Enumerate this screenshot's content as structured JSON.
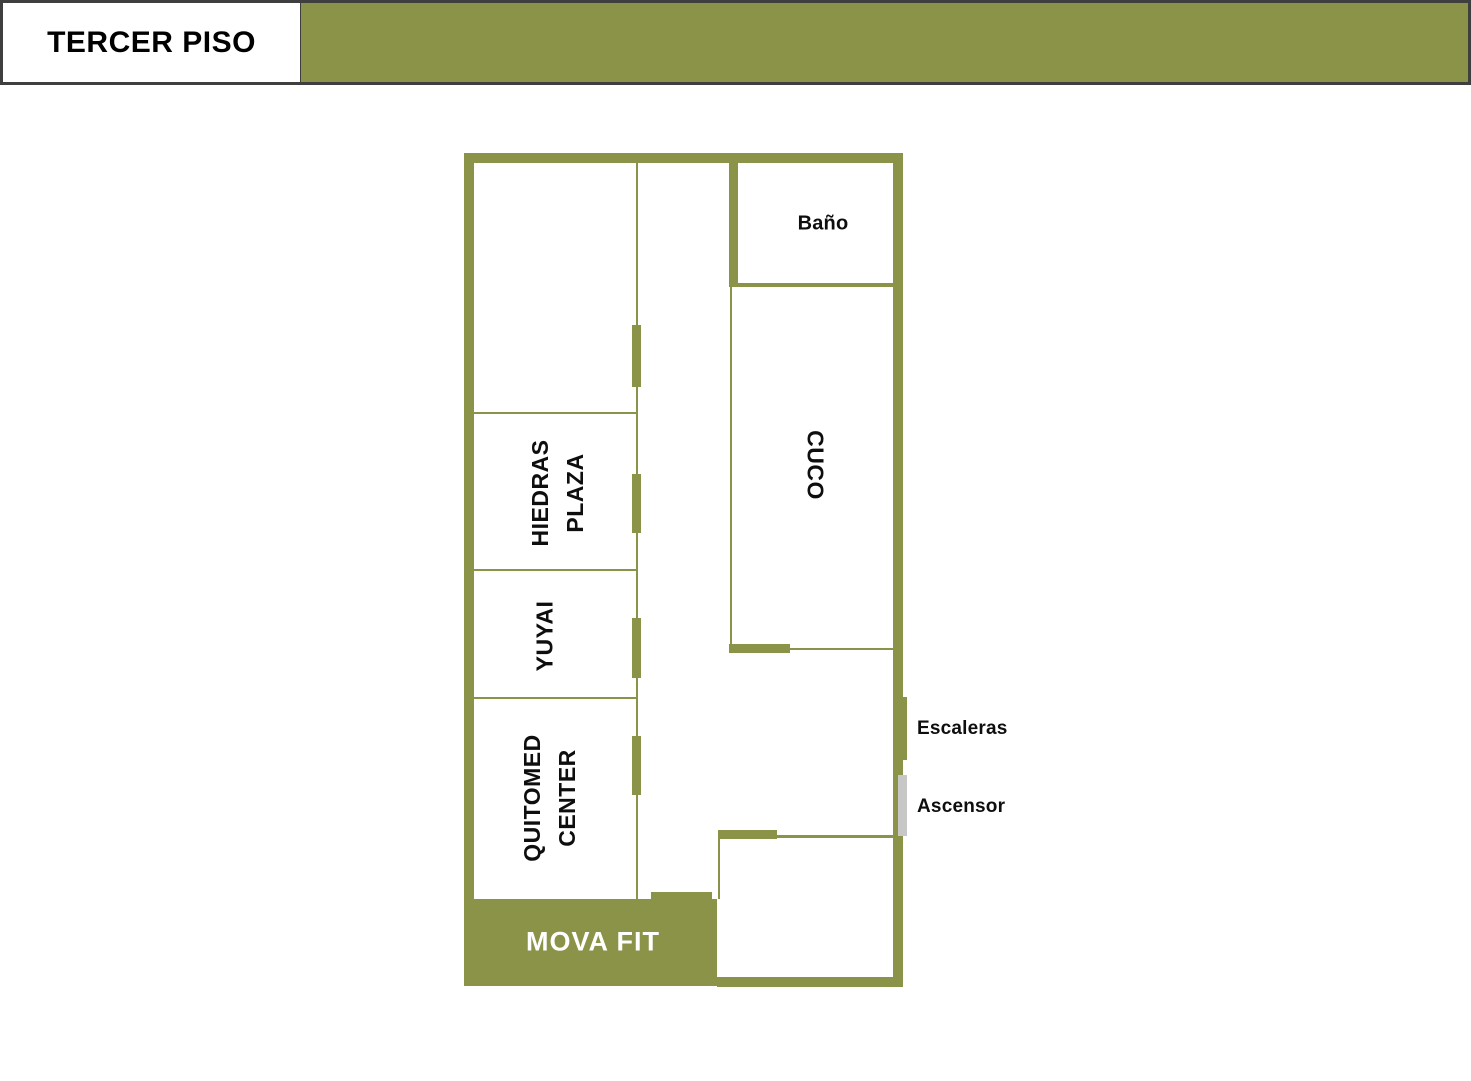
{
  "header": {
    "title": "TERCER PISO"
  },
  "colors": {
    "olive": "#8B9348",
    "header_border": "#3F3F3F",
    "elevator_gray": "#C7C7C7",
    "label_black": "#0E0E0E",
    "mova_label_white": "#FFFFFF"
  },
  "floor_plan": {
    "rooms": {
      "bano": {
        "label": "Baño"
      },
      "cuco": {
        "label": "CUCO"
      },
      "hiedras_plaza": {
        "line1": "HIEDRAS",
        "line2": "PLAZA"
      },
      "yuyai": {
        "label": "YUYAI"
      },
      "quitomed_center": {
        "line1": "QUITOMED",
        "line2": "CENTER"
      },
      "mova_fit": {
        "label": "MOVA FIT"
      }
    },
    "annotations": {
      "stairs": {
        "label": "Escaleras"
      },
      "elevator": {
        "label": "Ascensor"
      }
    }
  }
}
